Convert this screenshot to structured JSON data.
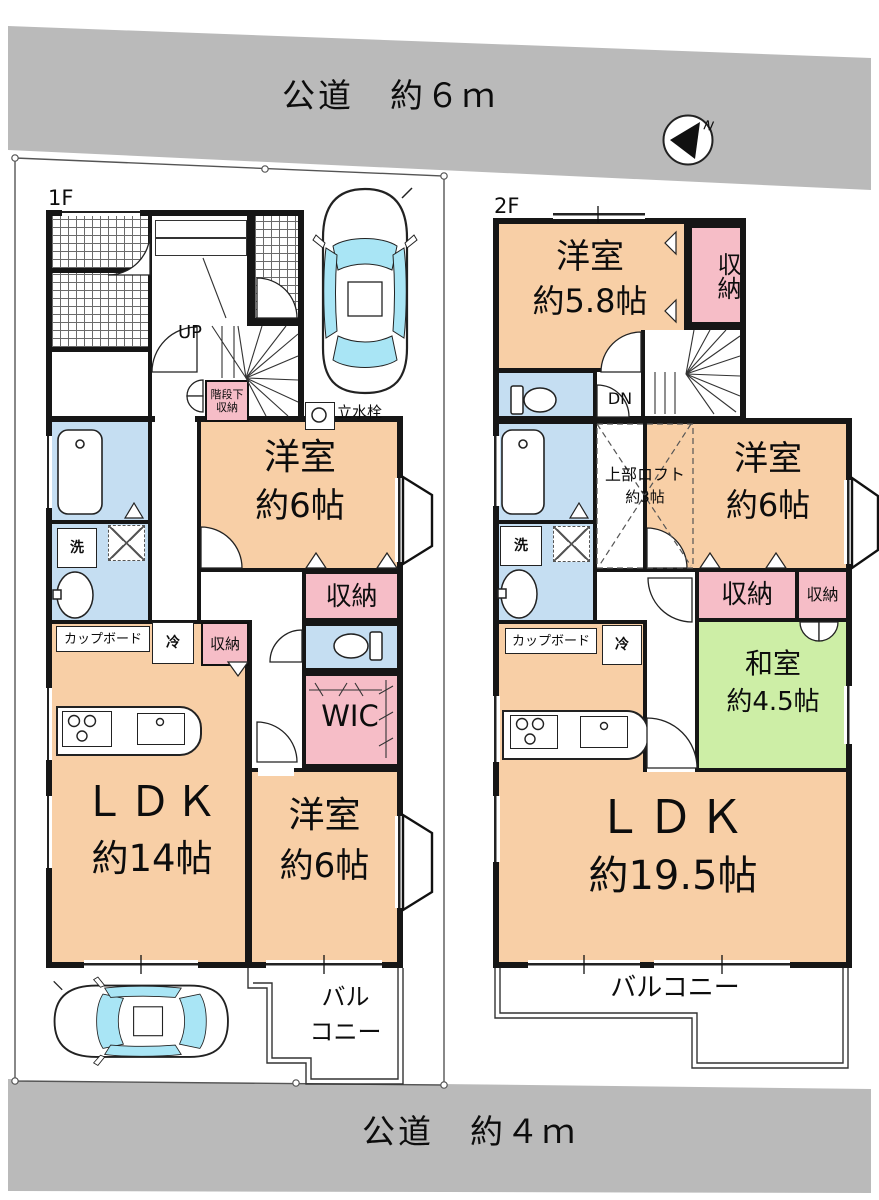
{
  "colors": {
    "room": "#f8cfa6",
    "storage": "#f6bdc7",
    "wet": "#c5def2",
    "tatami": "#cdeea6",
    "road": "#bababa",
    "car-glass": "#a9e5f5",
    "wall": "#161616"
  },
  "roads": {
    "top": "公道　約６ｍ",
    "bottom": "公道　約４ｍ"
  },
  "compass": {
    "north": "N"
  },
  "f1": {
    "label": "1F",
    "up": "UP",
    "under_stair1": "階段下",
    "under_stair2": "収納",
    "tap": "立水栓",
    "yo1_name": "洋室",
    "yo1_size": "約6帖",
    "shuno_mid": "収納",
    "wash": "洗",
    "cupboard": "カップボード",
    "fridge": "冷",
    "shuno_kitchen": "収納",
    "wic": "WIC",
    "ldk_name": "ＬＤＫ",
    "ldk_size": "約14帖",
    "yo2_name": "洋室",
    "yo2_size": "約6帖",
    "balcony1": "バル",
    "balcony2": "コニー"
  },
  "f2": {
    "label": "2F",
    "dn": "DN",
    "yo1_name": "洋室",
    "yo1_size": "約5.8帖",
    "shuno_top": "収納",
    "loft_name": "上部ロフト",
    "loft_size": "約3帖",
    "yo2_name": "洋室",
    "yo2_size": "約6帖",
    "shuno_a": "収納",
    "shuno_b": "収納",
    "wa_name": "和室",
    "wa_size": "約4.5帖",
    "wash": "洗",
    "cupboard": "カップボード",
    "fridge": "冷",
    "ldk_name": "ＬＤＫ",
    "ldk_size": "約19.5帖",
    "balcony": "バルコニー"
  }
}
